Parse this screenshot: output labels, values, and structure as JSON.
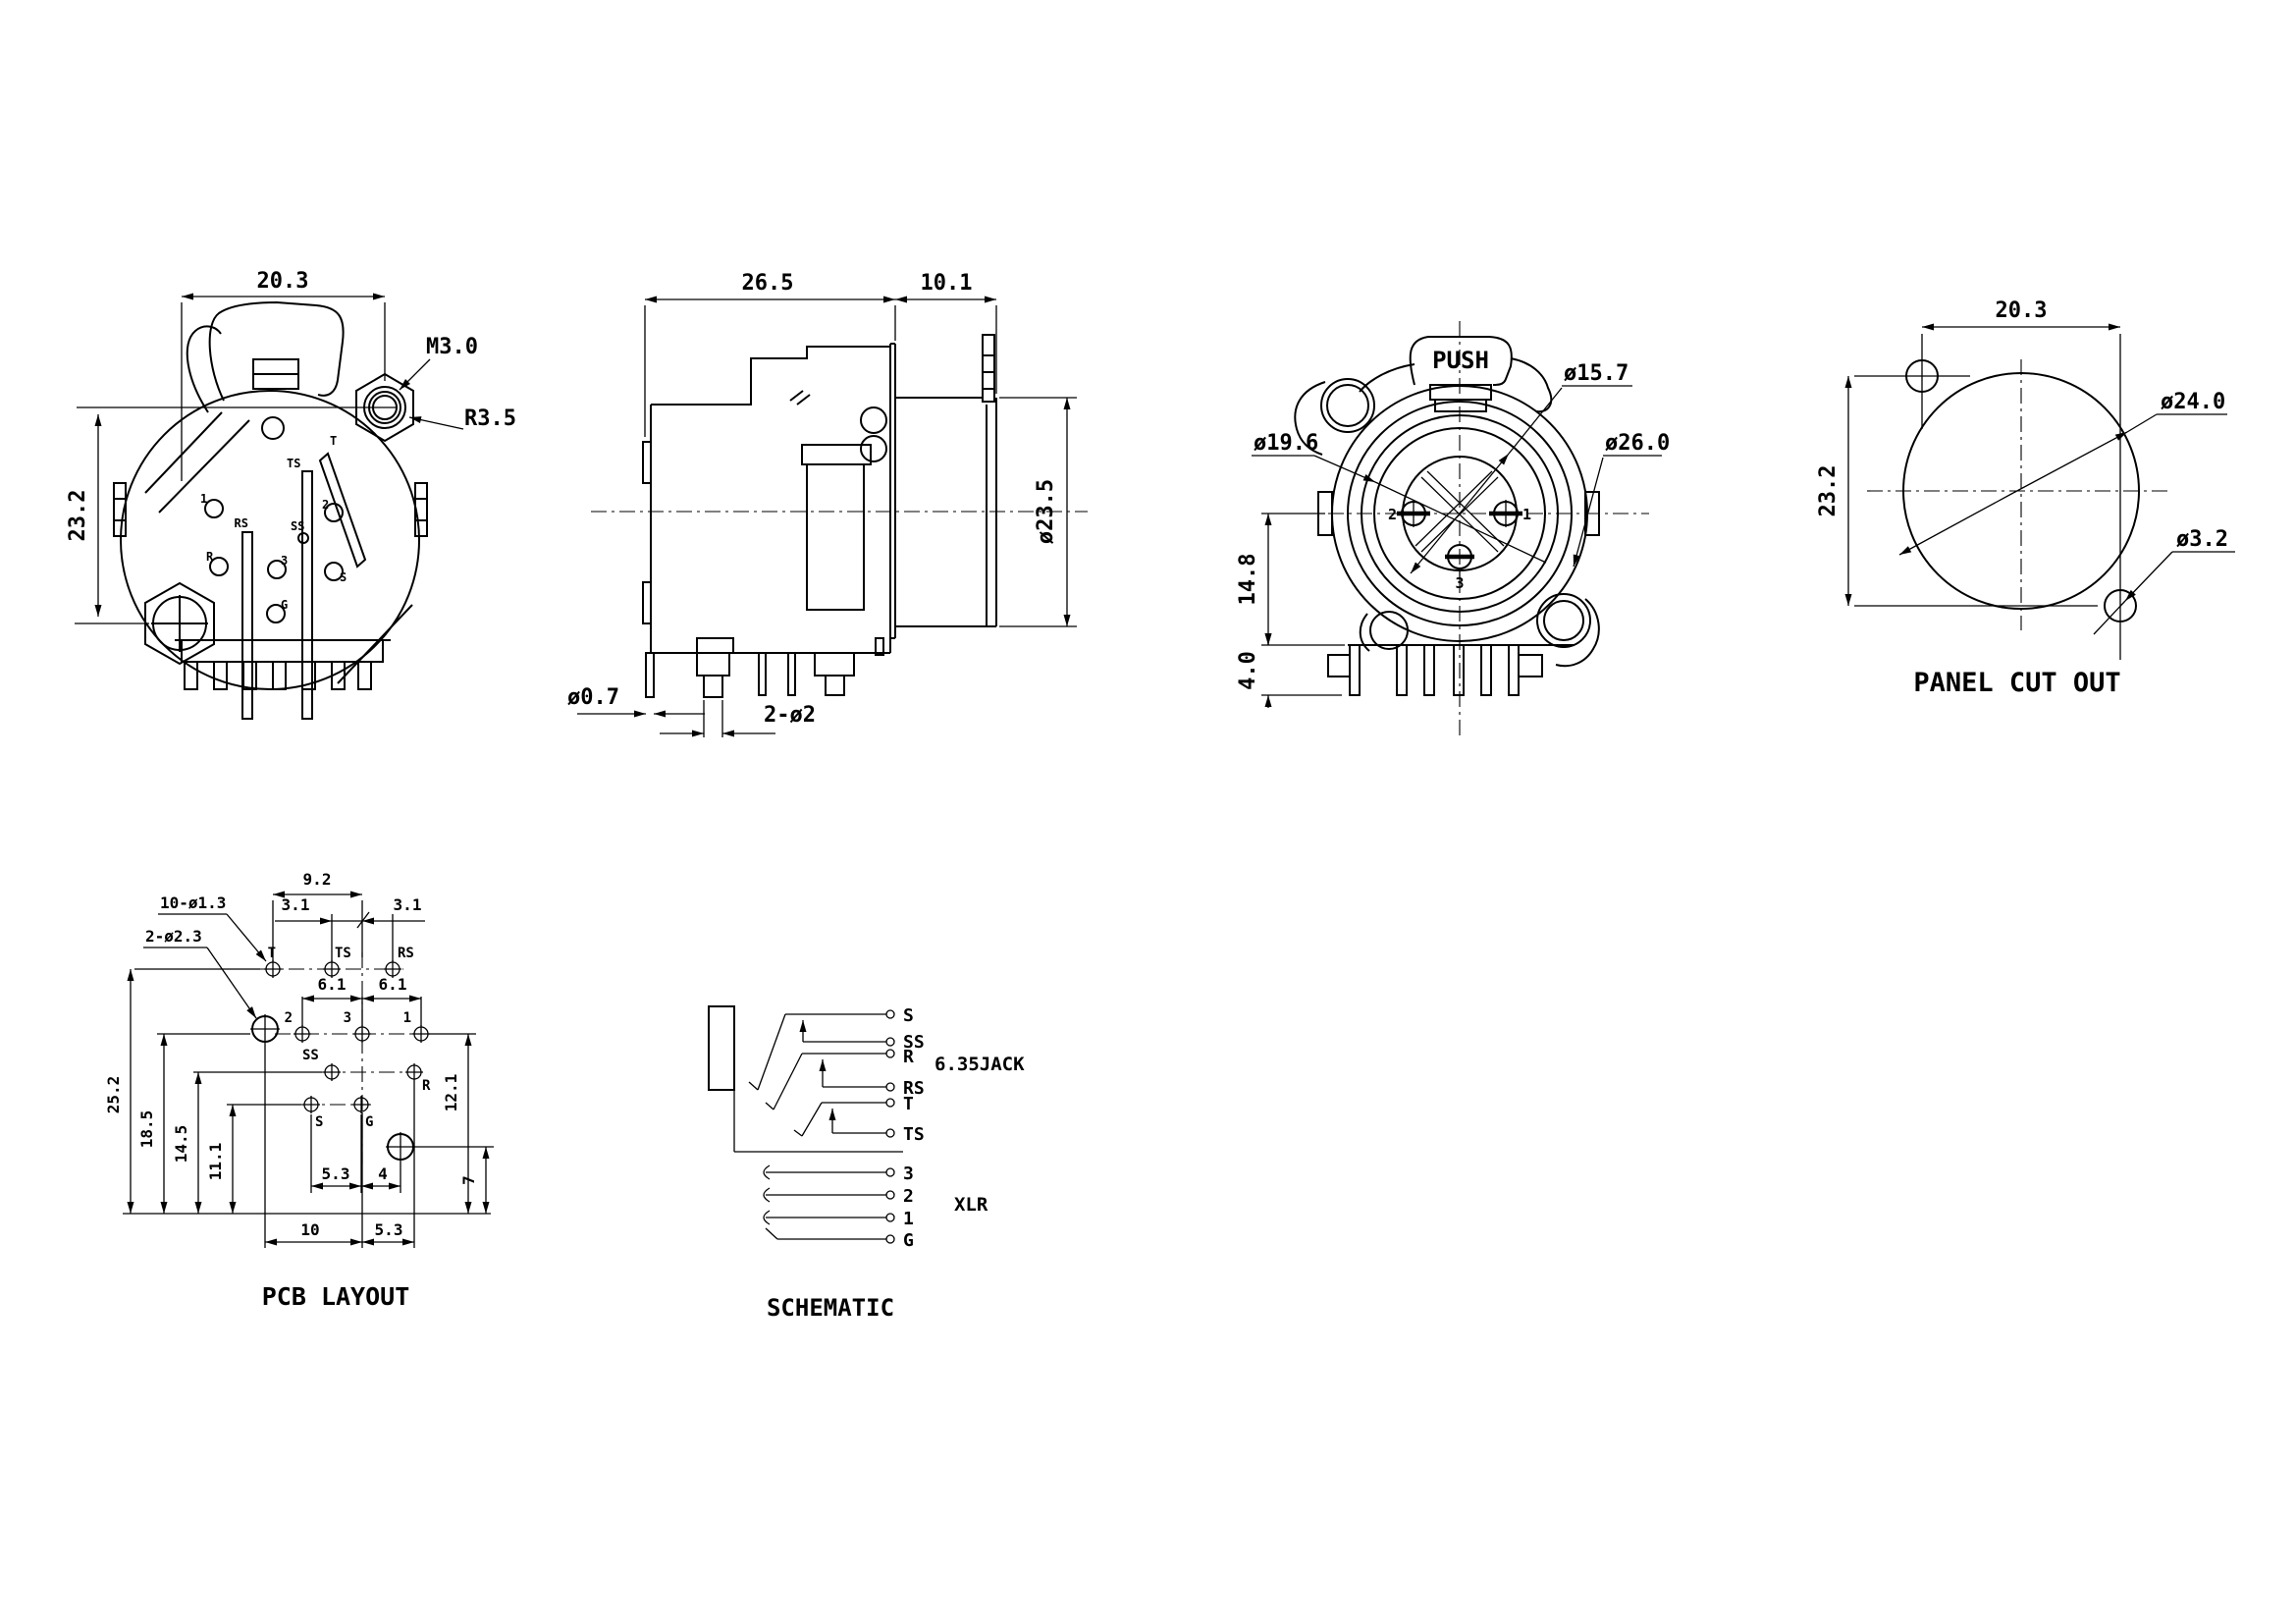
{
  "front_view": {
    "dim_width": "20.3",
    "dim_height": "23.2",
    "label_thread": "M3.0",
    "label_radius": "R3.5",
    "pin_1": "1",
    "pin_2": "2",
    "pin_3": "3",
    "pin_t": "T",
    "pin_ts": "TS",
    "pin_rs": "RS",
    "pin_ss": "SS",
    "pin_r": "R",
    "pin_s": "S",
    "pin_g": "G"
  },
  "side_view": {
    "dim_body_depth": "26.5",
    "dim_front_depth": "10.1",
    "dim_barrel_dia": "ø23.5",
    "dim_pin_dia": "ø0.7",
    "dim_pin_pair": "2-ø2"
  },
  "rear_view": {
    "label_push": "PUSH",
    "dia_inner": "ø15.7",
    "dia_middle": "ø19.6",
    "dia_outer": "ø26.0",
    "dim_center_height": "14.8",
    "dim_pin_length": "4.0",
    "pin_1": "1",
    "pin_2": "2",
    "pin_3": "3"
  },
  "panel_cutout": {
    "title": "PANEL CUT OUT",
    "dim_width": "20.3",
    "dim_height": "23.2",
    "dia_hole": "ø24.0",
    "dia_screw_hole": "ø3.2"
  },
  "pcb_layout": {
    "title": "PCB LAYOUT",
    "dim_top_width": "9.2",
    "dim_offset_left": "3.1",
    "dim_offset_right": "3.1",
    "label_small_holes": "10-ø1.3",
    "label_big_holes": "2-ø2.3",
    "dim_pitch_left": "6.1",
    "dim_pitch_right": "6.1",
    "dim_h_total": "25.2",
    "dim_h_row2": "18.5",
    "dim_h_row3": "14.5",
    "dim_h_row4": "11.1",
    "dim_right_upper": "12.1",
    "dim_right_lower": "7",
    "dim_bot_inner_left": "5.3",
    "dim_bot_inner_right": "4",
    "dim_bot_left": "10",
    "dim_bot_right": "5.3",
    "pad_t": "T",
    "pad_ts": "TS",
    "pad_rs": "RS",
    "pad_2": "2",
    "pad_3": "3",
    "pad_1": "1",
    "pad_ss": "SS",
    "pad_r": "R",
    "pad_s": "S",
    "pad_g": "G"
  },
  "schematic": {
    "title": "SCHEMATIC",
    "label_jack": "6.35JACK",
    "label_xlr": "XLR",
    "term_s": "S",
    "term_ss": "SS",
    "term_r": "R",
    "term_rs": "RS",
    "term_t": "T",
    "term_ts": "TS",
    "term_3": "3",
    "term_2": "2",
    "term_1": "1",
    "term_g": "G"
  }
}
